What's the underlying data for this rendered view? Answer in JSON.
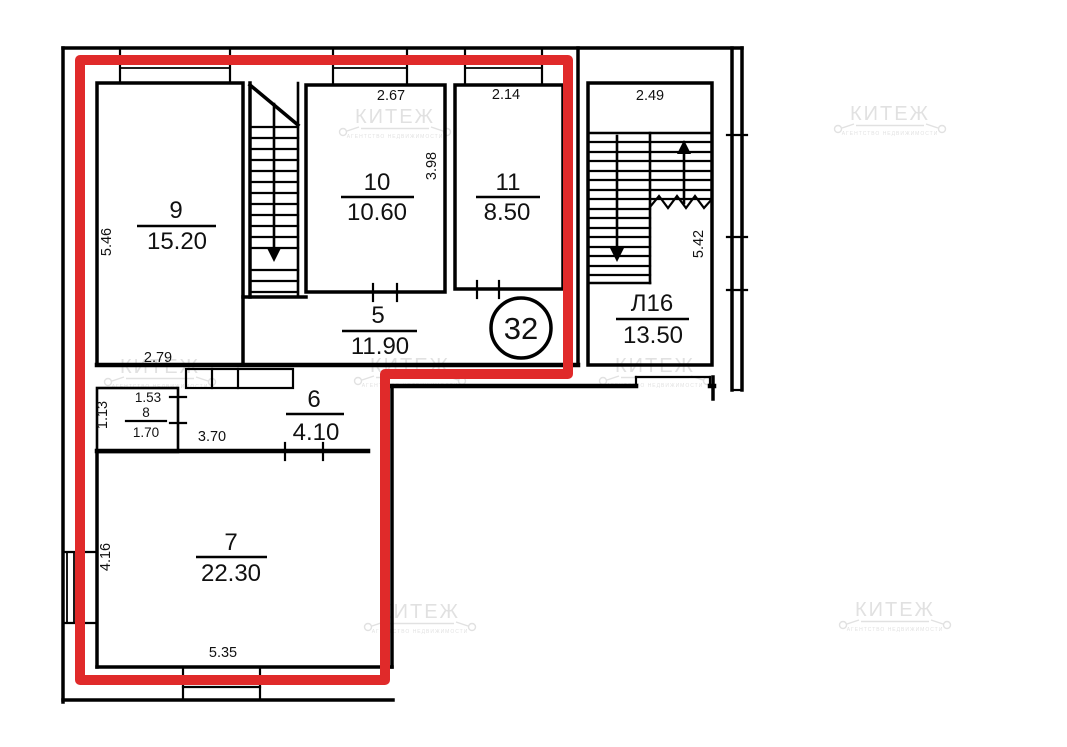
{
  "apartment": {
    "number": "32"
  },
  "rooms": {
    "r9": {
      "number": "9",
      "area": "15.20"
    },
    "r10": {
      "number": "10",
      "area": "10.60"
    },
    "r11": {
      "number": "11",
      "area": "8.50"
    },
    "r5": {
      "number": "5",
      "area": "11.90"
    },
    "r6": {
      "number": "6",
      "area": "4.10"
    },
    "r7": {
      "number": "7",
      "area": "22.30"
    },
    "r8": {
      "number": "8",
      "area": "1.70"
    },
    "stairwell": {
      "number": "Л16",
      "area": "13.50"
    }
  },
  "dimensions": {
    "room9_height": "5.46",
    "room9_width": "2.79",
    "room10_width": "2.67",
    "room10_height": "3.98",
    "room11_width": "2.14",
    "room6_width": "3.70",
    "room8_width": "1.53",
    "room8_height": "1.13",
    "room7_height": "4.16",
    "room7_width": "5.35",
    "stairwell_width": "2.49",
    "stairwell_height": "5.42"
  },
  "watermark": {
    "brand": "КИТЕЖ",
    "tagline": "АГЕНТСТВО НЕДВИЖИМОСТИ"
  },
  "colors": {
    "highlight": "#e02a2a",
    "wall": "#000000",
    "watermark": "#c9c9c9",
    "background": "#ffffff"
  }
}
